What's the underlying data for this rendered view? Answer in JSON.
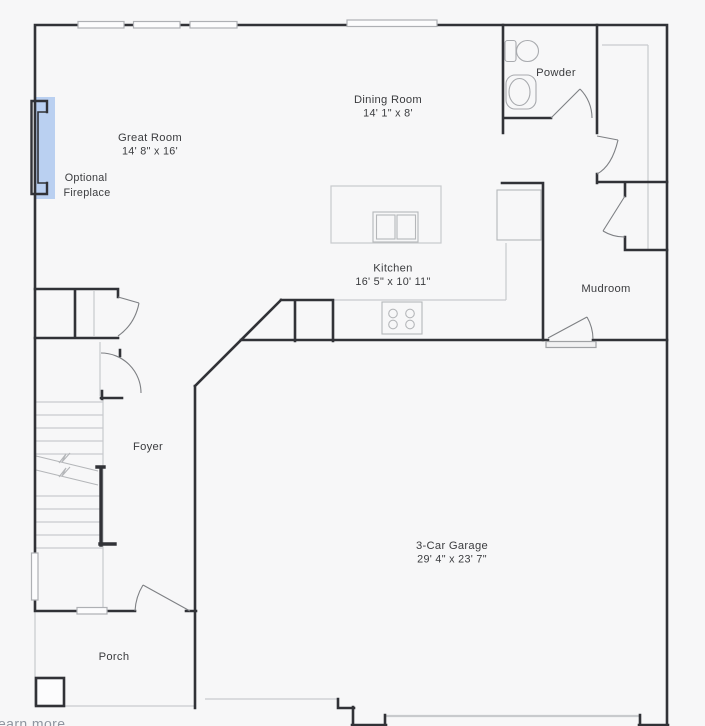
{
  "colors": {
    "background": "#f7f7f8",
    "wall": "#313237",
    "light_line": "#c8cacd",
    "break_line": "#b4b6b9",
    "door_line": "#7e8084",
    "fixture_line": "#a8aaae",
    "text": "#3b3c3f",
    "fireplace_highlight": "#bad0f1",
    "link_text": "#8f96a0"
  },
  "rooms": {
    "great_room": {
      "name": "Great Room",
      "dimensions": "14' 8\" x 16'"
    },
    "dining_room": {
      "name": "Dining Room",
      "dimensions": "14' 1\" x 8'"
    },
    "powder": {
      "name": "Powder"
    },
    "kitchen": {
      "name": "Kitchen",
      "dimensions": "16' 5\" x 10' 11\""
    },
    "mudroom": {
      "name": "Mudroom"
    },
    "foyer": {
      "name": "Foyer"
    },
    "garage": {
      "name": "3-Car Garage",
      "dimensions": "29' 4\" x 23' 7\""
    },
    "porch": {
      "name": "Porch"
    }
  },
  "annotations": {
    "fireplace_line1": "Optional",
    "fireplace_line2": "Fireplace",
    "partial_link": "earn more"
  }
}
